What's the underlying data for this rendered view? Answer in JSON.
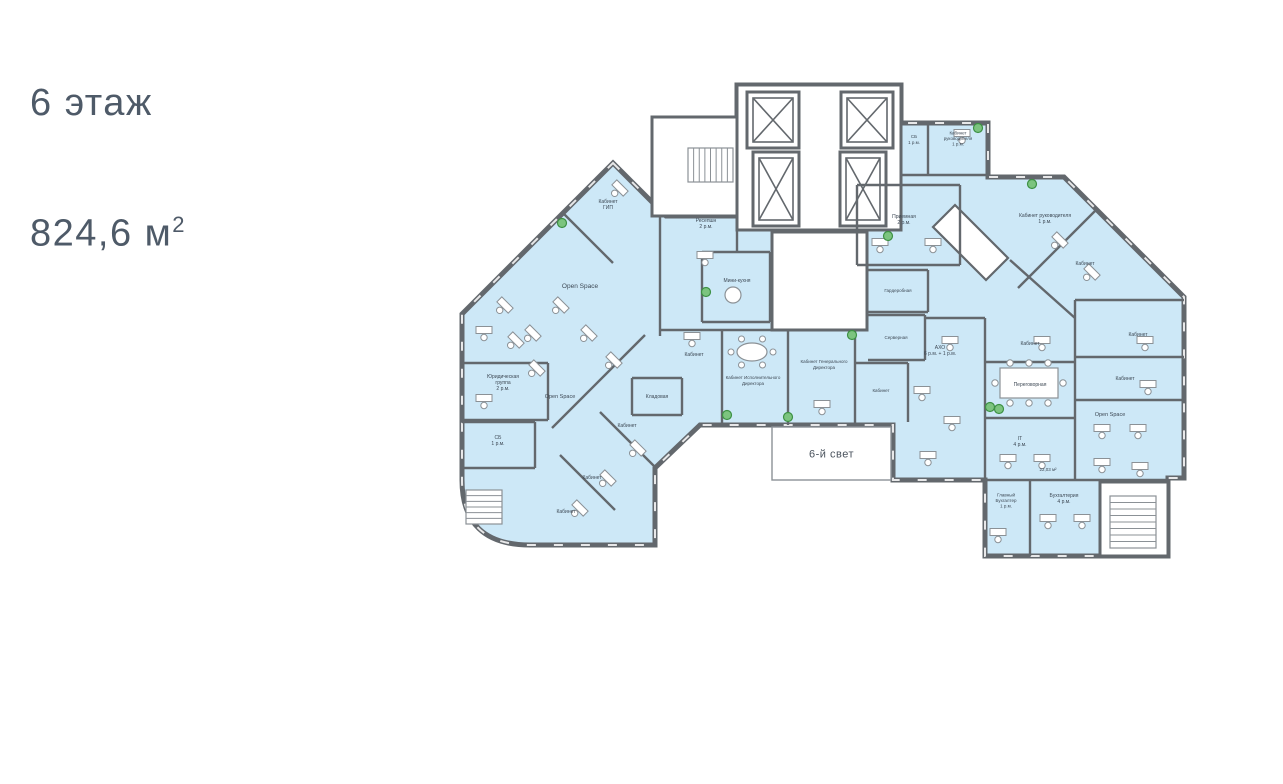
{
  "header": {
    "floor_label": "6 этаж",
    "area_value": "824,6 м",
    "area_sup": "2"
  },
  "plan": {
    "colors": {
      "room_fill": "#cde8f7",
      "wall": "#63686d",
      "wall_light": "#8b9196",
      "white": "#ffffff",
      "label": "#3d4854",
      "plant_fill": "#7cc47f",
      "plant_stroke": "#3d9144",
      "atrium_text": "#49525c"
    },
    "outline_path": "M 613 163 L 666 216 L 737 216 L 737 85 L 901 85 L 901 123 L 988 123 L 988 177 L 1064 177 L 1184 297 L 1184 478 L 1168 478 L 1168 556 L 985 556 L 985 480 L 893 480 L 893 425 L 770 425 L 700 425 L 655 468 L 655 545 L 530 545 Q 462 545 462 480 L 462 314 Z",
    "white_areas": [
      {
        "name": "elevator-core",
        "rect": [
          737,
          85,
          164,
          145
        ]
      },
      {
        "name": "stair-annex",
        "rect": [
          652,
          117,
          85,
          99
        ]
      },
      {
        "name": "wc-block",
        "rect": [
          772,
          232,
          95,
          98
        ]
      },
      {
        "name": "stairwell-bottom-right",
        "rect": [
          1100,
          482,
          68,
          74
        ]
      },
      {
        "name": "diagonal-corridor",
        "poly": [
          [
            955,
            205
          ],
          [
            1008,
            258
          ],
          [
            986,
            280
          ],
          [
            933,
            227
          ]
        ]
      }
    ],
    "atrium": {
      "label": "6-й свет",
      "rect": [
        772,
        427,
        119,
        53
      ]
    },
    "elevators": [
      [
        747,
        92,
        52,
        56
      ],
      [
        841,
        92,
        52,
        56
      ],
      [
        753,
        152,
        46,
        74
      ],
      [
        840,
        152,
        46,
        74
      ]
    ],
    "walls": [
      [
        563,
        213,
        613,
        263
      ],
      [
        660,
        216,
        660,
        336
      ],
      [
        702,
        252,
        770,
        252
      ],
      [
        770,
        252,
        770,
        322
      ],
      [
        702,
        322,
        770,
        322
      ],
      [
        702,
        252,
        702,
        322
      ],
      [
        737,
        216,
        737,
        252
      ],
      [
        462,
        363,
        548,
        363
      ],
      [
        548,
        363,
        548,
        420
      ],
      [
        462,
        420,
        548,
        420
      ],
      [
        462,
        422,
        535,
        422
      ],
      [
        535,
        422,
        535,
        468
      ],
      [
        462,
        468,
        535,
        468
      ],
      [
        632,
        378,
        682,
        378
      ],
      [
        682,
        378,
        682,
        415
      ],
      [
        632,
        415,
        682,
        415
      ],
      [
        632,
        378,
        632,
        415
      ],
      [
        552,
        428,
        645,
        335
      ],
      [
        600,
        412,
        655,
        467
      ],
      [
        560,
        455,
        615,
        510
      ],
      [
        660,
        330,
        868,
        330
      ],
      [
        722,
        330,
        722,
        425
      ],
      [
        788,
        330,
        788,
        425
      ],
      [
        855,
        330,
        855,
        425
      ],
      [
        855,
        363,
        908,
        363
      ],
      [
        908,
        363,
        908,
        422
      ],
      [
        868,
        315,
        925,
        315
      ],
      [
        925,
        315,
        925,
        360
      ],
      [
        868,
        360,
        925,
        360
      ],
      [
        868,
        270,
        928,
        270
      ],
      [
        928,
        270,
        928,
        312
      ],
      [
        868,
        312,
        928,
        312
      ],
      [
        925,
        318,
        985,
        318
      ],
      [
        857,
        185,
        960,
        185
      ],
      [
        857,
        185,
        857,
        265
      ],
      [
        857,
        265,
        960,
        265
      ],
      [
        960,
        185,
        960,
        265
      ],
      [
        928,
        123,
        928,
        175
      ],
      [
        901,
        175,
        988,
        175
      ],
      [
        1098,
        208,
        1018,
        288
      ],
      [
        1075,
        300,
        1184,
        300
      ],
      [
        1010,
        260,
        1075,
        318
      ],
      [
        985,
        318,
        985,
        480
      ],
      [
        985,
        362,
        1075,
        362
      ],
      [
        985,
        418,
        1075,
        418
      ],
      [
        1075,
        300,
        1075,
        480
      ],
      [
        1075,
        357,
        1184,
        357
      ],
      [
        1075,
        400,
        1184,
        400
      ],
      [
        985,
        480,
        1168,
        480
      ],
      [
        1030,
        480,
        1030,
        556
      ],
      [
        1100,
        480,
        1100,
        556
      ]
    ],
    "stairs": [
      {
        "x": 688,
        "y": 148,
        "w": 45,
        "h": 34,
        "steps": 8,
        "dir": "v"
      },
      {
        "x": 466,
        "y": 490,
        "w": 36,
        "h": 34,
        "steps": 6,
        "dir": "h"
      },
      {
        "x": 1110,
        "y": 496,
        "w": 46,
        "h": 52,
        "steps": 8,
        "dir": "h"
      }
    ],
    "rooms": [
      {
        "name": "kabinet-gip",
        "lines": [
          "Кабинет",
          "ГИП"
        ],
        "x": 608,
        "y": 206,
        "fs": 5
      },
      {
        "name": "open-space-left-upper",
        "lines": [
          "Open Space"
        ],
        "x": 580,
        "y": 288,
        "fs": 6.5
      },
      {
        "name": "open-space-left-lower",
        "lines": [
          "Open Space"
        ],
        "x": 560,
        "y": 398,
        "fs": 5.5
      },
      {
        "name": "yur-gruppa",
        "lines": [
          "Юридическая",
          "группа",
          "2 р.м."
        ],
        "x": 503,
        "y": 384,
        "fs": 5
      },
      {
        "name": "sb-left",
        "lines": [
          "СБ",
          "1 р.м."
        ],
        "x": 498,
        "y": 442,
        "fs": 5
      },
      {
        "name": "kladovaya",
        "lines": [
          "Кладовая"
        ],
        "x": 657,
        "y": 398,
        "fs": 5
      },
      {
        "name": "kabinet-lw-1",
        "lines": [
          "Кабинет"
        ],
        "x": 627,
        "y": 427,
        "fs": 5
      },
      {
        "name": "kabinet-lw-2",
        "lines": [
          "Кабинет"
        ],
        "x": 592,
        "y": 479,
        "fs": 5
      },
      {
        "name": "kabinet-lw-3",
        "lines": [
          "Кабинет"
        ],
        "x": 566,
        "y": 513,
        "fs": 5
      },
      {
        "name": "resepshn",
        "lines": [
          "Ресепшн",
          "2 р.м."
        ],
        "x": 706,
        "y": 225,
        "fs": 5
      },
      {
        "name": "mini-kuhnya",
        "lines": [
          "Мини-кухня"
        ],
        "x": 737,
        "y": 282,
        "fs": 5
      },
      {
        "name": "priemnaya",
        "lines": [
          "Приемная",
          "2 р.м."
        ],
        "x": 904,
        "y": 221,
        "fs": 5
      },
      {
        "name": "sb-top",
        "lines": [
          "СБ",
          "1 р.м."
        ],
        "x": 914,
        "y": 141,
        "fs": 4.5
      },
      {
        "name": "kabinet-rukovoditelya-top",
        "lines": [
          "Кабинет",
          "руководителя",
          "1 р.м."
        ],
        "x": 958,
        "y": 140,
        "fs": 4.5
      },
      {
        "name": "kabinet-rukovoditelya-diag",
        "lines": [
          "Кабинет руководителя",
          "1 р.м."
        ],
        "x": 1045,
        "y": 220,
        "fs": 5
      },
      {
        "name": "kabinet-diag",
        "lines": [
          "Кабинет"
        ],
        "x": 1085,
        "y": 265,
        "fs": 5
      },
      {
        "name": "garderobnaya",
        "lines": [
          "Гардеробная"
        ],
        "x": 898,
        "y": 292,
        "fs": 4.5
      },
      {
        "name": "servernaya",
        "lines": [
          "Серверная"
        ],
        "x": 896,
        "y": 339,
        "fs": 4.5
      },
      {
        "name": "kabinet-center-small",
        "lines": [
          "Кабинет"
        ],
        "x": 881,
        "y": 392,
        "fs": 4.5
      },
      {
        "name": "kabinet-left-office",
        "lines": [
          "Кабинет"
        ],
        "x": 694,
        "y": 356,
        "fs": 5
      },
      {
        "name": "kabinet-ispolnitelnogo",
        "lines": [
          "Кабинет Исполнительного",
          "Директора"
        ],
        "x": 753,
        "y": 382,
        "fs": 4.5
      },
      {
        "name": "kabinet-generalnogo",
        "lines": [
          "Кабинет Генерального",
          "Директора"
        ],
        "x": 824,
        "y": 366,
        "fs": 4.5
      },
      {
        "name": "aho",
        "lines": [
          "АХО",
          "6 р.м. + 1 р.м."
        ],
        "x": 940,
        "y": 352,
        "fs": 5
      },
      {
        "name": "kabinet-col-1",
        "lines": [
          "Кабинет"
        ],
        "x": 1030,
        "y": 345,
        "fs": 5
      },
      {
        "name": "peregovornaya",
        "lines": [
          "Переговорная"
        ],
        "x": 1030,
        "y": 386,
        "fs": 5
      },
      {
        "name": "it-room",
        "lines": [
          "IT",
          "4 р.м."
        ],
        "x": 1020,
        "y": 443,
        "fs": 5
      },
      {
        "name": "it-room-area",
        "lines": [
          "22,03 м²"
        ],
        "x": 1048,
        "y": 471,
        "fs": 4.5
      },
      {
        "name": "kabinet-right-1",
        "lines": [
          "Кабинет"
        ],
        "x": 1138,
        "y": 336,
        "fs": 5
      },
      {
        "name": "kabinet-right-2",
        "lines": [
          "Кабинет"
        ],
        "x": 1125,
        "y": 380,
        "fs": 5
      },
      {
        "name": "open-space-right",
        "lines": [
          "Open Space"
        ],
        "x": 1110,
        "y": 416,
        "fs": 5.5
      },
      {
        "name": "glavnyi-buhgalter",
        "lines": [
          "Главный",
          "Бухгалтер",
          "1 р.м."
        ],
        "x": 1006,
        "y": 502,
        "fs": 4.5
      },
      {
        "name": "buhgalteriya",
        "lines": [
          "Бухгалтерия",
          "4 р.м."
        ],
        "x": 1064,
        "y": 500,
        "fs": 5
      }
    ],
    "desks": [
      {
        "x": 505,
        "y": 305,
        "r": 45
      },
      {
        "x": 533,
        "y": 333,
        "r": 45
      },
      {
        "x": 561,
        "y": 305,
        "r": 45
      },
      {
        "x": 589,
        "y": 333,
        "r": 45
      },
      {
        "x": 614,
        "y": 360,
        "r": 45
      },
      {
        "x": 537,
        "y": 368,
        "r": 45
      },
      {
        "x": 484,
        "y": 330,
        "r": 0
      },
      {
        "x": 516,
        "y": 340,
        "r": 45
      },
      {
        "x": 484,
        "y": 398,
        "r": 0
      },
      {
        "x": 638,
        "y": 448,
        "r": 45
      },
      {
        "x": 608,
        "y": 478,
        "r": 45
      },
      {
        "x": 580,
        "y": 508,
        "r": 45
      },
      {
        "x": 705,
        "y": 255,
        "r": 0
      },
      {
        "x": 880,
        "y": 242,
        "r": 0
      },
      {
        "x": 933,
        "y": 242,
        "r": 0
      },
      {
        "x": 962,
        "y": 133,
        "r": 0
      },
      {
        "x": 1060,
        "y": 240,
        "r": 45
      },
      {
        "x": 1092,
        "y": 272,
        "r": 45
      },
      {
        "x": 692,
        "y": 336,
        "r": 0
      },
      {
        "x": 822,
        "y": 404,
        "r": 0
      },
      {
        "x": 950,
        "y": 340,
        "r": 0
      },
      {
        "x": 922,
        "y": 390,
        "r": 0
      },
      {
        "x": 952,
        "y": 420,
        "r": 0
      },
      {
        "x": 928,
        "y": 455,
        "r": 0
      },
      {
        "x": 1042,
        "y": 340,
        "r": 0
      },
      {
        "x": 1008,
        "y": 458,
        "r": 0
      },
      {
        "x": 1042,
        "y": 458,
        "r": 0
      },
      {
        "x": 1145,
        "y": 340,
        "r": 0
      },
      {
        "x": 1148,
        "y": 384,
        "r": 0
      },
      {
        "x": 1102,
        "y": 428,
        "r": 0
      },
      {
        "x": 1138,
        "y": 428,
        "r": 0
      },
      {
        "x": 1102,
        "y": 462,
        "r": 0
      },
      {
        "x": 1140,
        "y": 466,
        "r": 0
      },
      {
        "x": 998,
        "y": 532,
        "r": 0
      },
      {
        "x": 1048,
        "y": 518,
        "r": 0
      },
      {
        "x": 1082,
        "y": 518,
        "r": 0
      },
      {
        "x": 620,
        "y": 188,
        "r": 45
      }
    ],
    "meeting_table": {
      "x": 1000,
      "y": 368,
      "w": 58,
      "h": 30
    },
    "oval_table": {
      "cx": 752,
      "cy": 352,
      "rx": 15,
      "ry": 9
    },
    "kitchen_table": {
      "cx": 733,
      "cy": 295,
      "r": 8
    },
    "plants": [
      [
        562,
        223
      ],
      [
        706,
        292
      ],
      [
        727,
        415
      ],
      [
        788,
        417
      ],
      [
        852,
        335
      ],
      [
        888,
        236
      ],
      [
        978,
        128
      ],
      [
        1032,
        184
      ],
      [
        990,
        407
      ],
      [
        999,
        409
      ]
    ]
  }
}
